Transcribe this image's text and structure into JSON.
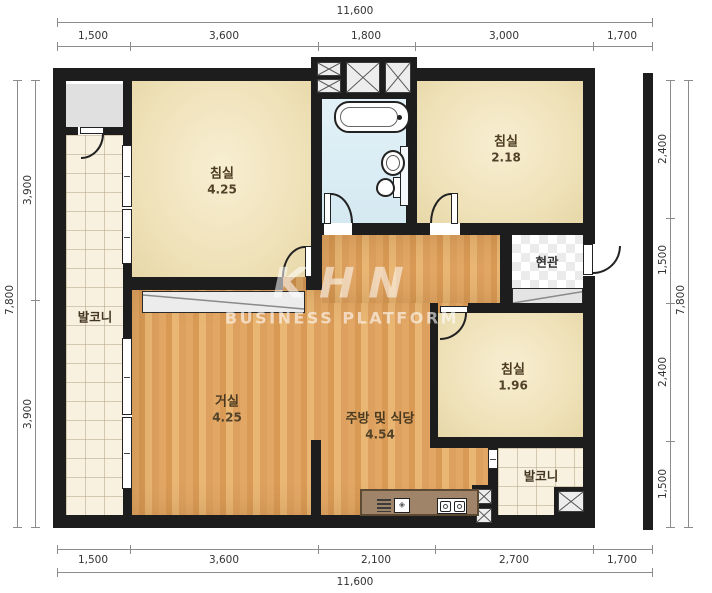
{
  "watermark": {
    "logo": "KHN",
    "subtitle": "BUSINESS PLATFORM"
  },
  "rooms": {
    "bedroom1": {
      "name": "침실",
      "area": "4.25"
    },
    "bedroom2": {
      "name": "침실",
      "area": "2.18"
    },
    "bedroom3": {
      "name": "침실",
      "area": "1.96"
    },
    "living": {
      "name": "거실",
      "area": "4.25"
    },
    "kitchen": {
      "name": "주방 및 식당",
      "area": "4.54"
    },
    "balcony_left": {
      "name": "발코니"
    },
    "balcony_bottom": {
      "name": "발코니"
    },
    "entrance": {
      "name": "현관"
    }
  },
  "dims": {
    "top": {
      "total": "11,600",
      "segments": [
        "1,500",
        "3,600",
        "1,800",
        "3,000",
        "1,700"
      ]
    },
    "bottom": {
      "total": "11,600",
      "segments": [
        "1,500",
        "3,600",
        "2,100",
        "2,700",
        "1,700"
      ]
    },
    "left": {
      "total": "7,800",
      "segments": [
        "3,900",
        "3,900"
      ]
    },
    "right": {
      "total": "7,800",
      "segments": [
        "2,400",
        "1,500",
        "2,400",
        "1,500"
      ]
    }
  },
  "colors": {
    "wall": "#1d1d1d",
    "wood_floor": "#e2a765",
    "bedroom_floor": "#f2e6c4",
    "balcony_tile": "#f9f1e0",
    "bathroom_floor": "#dceef6",
    "counter": "#a0846a",
    "dimension_text": "#333333"
  }
}
